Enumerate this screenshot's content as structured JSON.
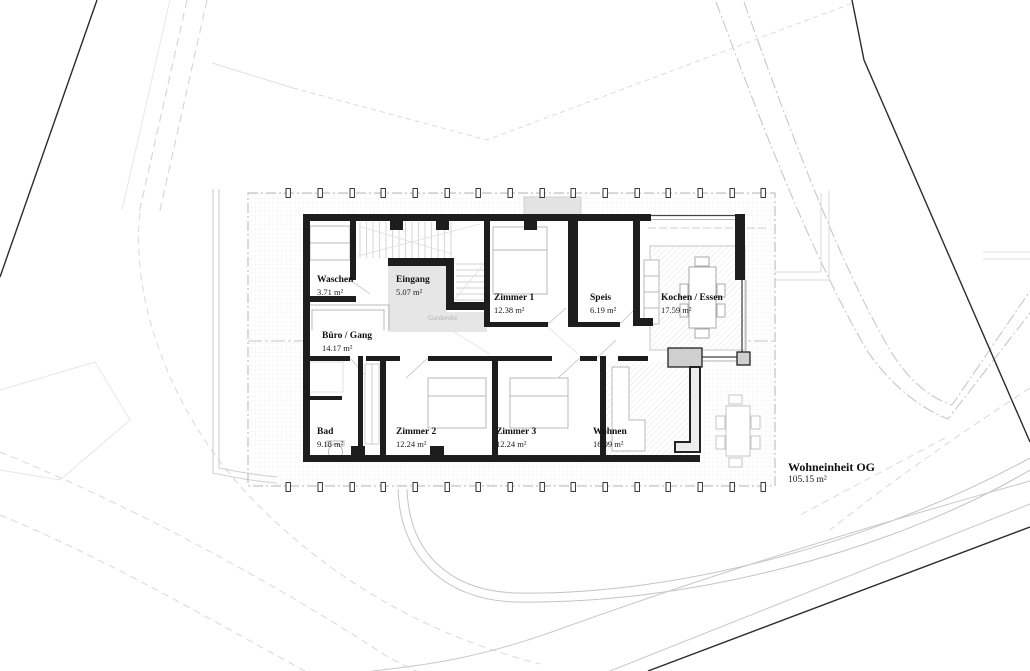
{
  "plan": {
    "title": {
      "label": "Wohneinheit OG",
      "area": "105.15 m²"
    },
    "rooms": [
      {
        "id": "waschen",
        "label": "Waschen",
        "area": "3.71 m²"
      },
      {
        "id": "eingang",
        "label": "Eingang",
        "area": "5.07 m²"
      },
      {
        "id": "zimmer1",
        "label": "Zimmer 1",
        "area": "12.38 m²"
      },
      {
        "id": "speis",
        "label": "Speis",
        "area": "6.19 m²"
      },
      {
        "id": "kochen-essen",
        "label": "Kochen / Essen",
        "area": "17.59 m²"
      },
      {
        "id": "buero-gang",
        "label": "Büro / Gang",
        "area": "14.17 m²"
      },
      {
        "id": "bad",
        "label": "Bad",
        "area": "9.18 m²"
      },
      {
        "id": "zimmer2",
        "label": "Zimmer 2",
        "area": "12.24 m²"
      },
      {
        "id": "zimmer3",
        "label": "Zimmer 3",
        "area": "12.24 m²"
      },
      {
        "id": "wohnen",
        "label": "Wohnen",
        "area": "16.09 m²"
      }
    ],
    "annotations": {
      "garderobe": "Garderobe"
    },
    "colors": {
      "wall": "#1d1d1d",
      "concrete": "#cfcfcf",
      "entry_floor": "#e6e6e6",
      "grid_line": "#ececec",
      "hatch_line": "#dedede",
      "furniture": "#b8b8b8",
      "site_boundary": "#2b2b2b",
      "road": "#c9c9c9",
      "contour": "#d9d9d9"
    }
  }
}
